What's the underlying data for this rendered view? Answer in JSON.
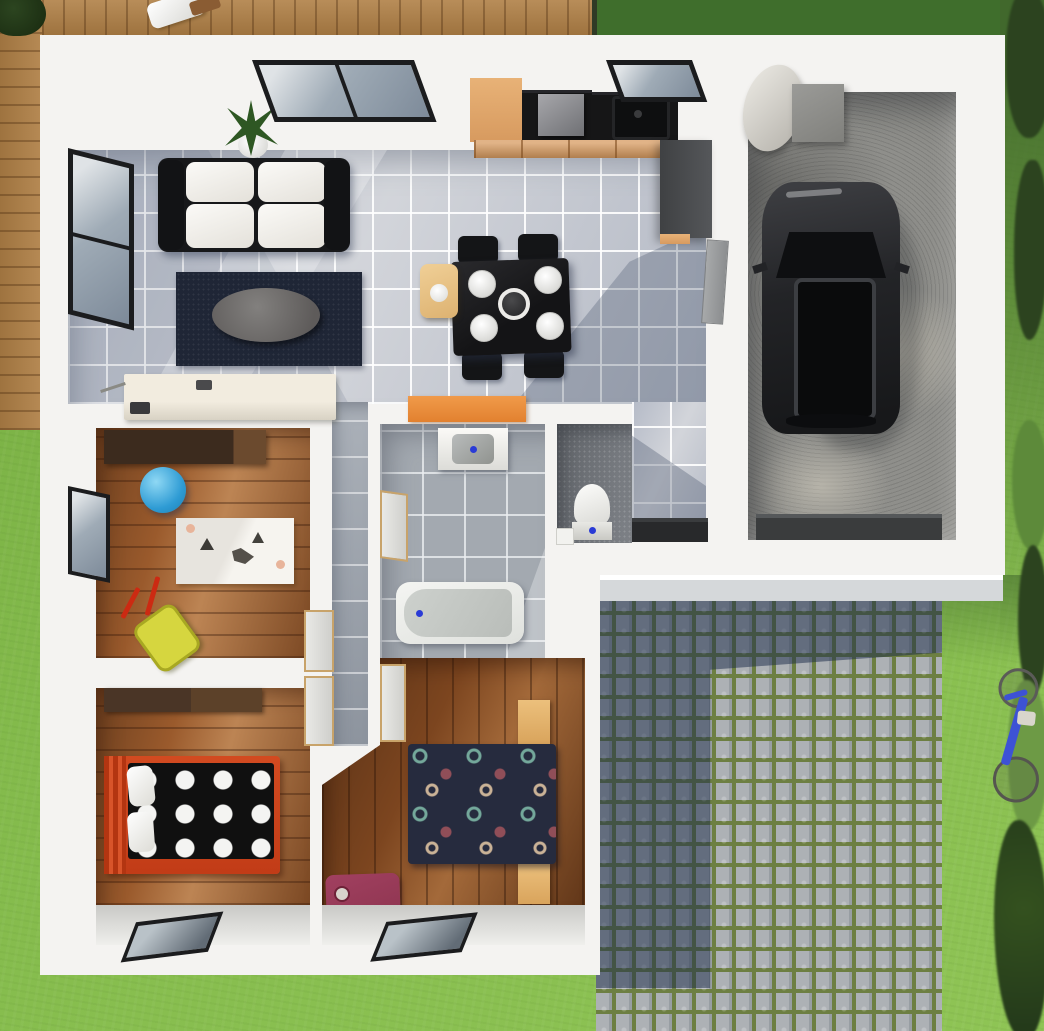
{
  "scene": {
    "kind": "3d-architectural-floor-plan-render",
    "view": "top-down",
    "size": {
      "width": 1044,
      "height": 1031
    }
  },
  "palette": {
    "grass_dark": "#41682c",
    "deck_wood": "#b08046",
    "wall_white": "#f4f3f1",
    "tile_light": "#c6c9d0",
    "wood_floor": "#9a5a2c",
    "wood_floor_dark": "#7c451f",
    "bath_tile": "#a3a9b0",
    "wc_tile": "#73777d",
    "concrete": "#8f8f8b",
    "moss": "#6d7f42",
    "cobble_shadow": "rgba(26,41,72,0.50)",
    "step": "#d5d8da",
    "counter_black": "#161617",
    "cab_wood": "#d79a5f",
    "frame_dark": "#1b1c1e",
    "wood_trim": "#c8a36a",
    "rug_navy": "#1f2636",
    "sofa_black": "#17181a",
    "orange_cabinet": "#e2812f",
    "red_bed": "#c23c17",
    "duvet_black": "#101010",
    "duvet_navy": "#262b3e",
    "blue_ball": "#2e9bd4",
    "yellow_toy": "#d6d63f",
    "maroon_bag": "#8e3550",
    "bike_blue": "#3d52d5",
    "bush_dark": "#2c431f",
    "bush_light": "#6d9a45",
    "car_body": "#232427",
    "accent_blue": "#2a3bd6"
  },
  "rooms": [
    {
      "name": "living-room",
      "furniture": [
        "sofa",
        "coffee-table",
        "navy-rug",
        "potted-plant",
        "sideboard",
        "west-window",
        "top-window"
      ]
    },
    {
      "name": "kitchen-dining",
      "furniture": [
        "tall-cabinet",
        "cooktop-with-hood",
        "black-counter",
        "sink",
        "drawer-run",
        "side-counter",
        "dining-table",
        "four-chairs",
        "four-plates",
        "center-bowl",
        "high-chair",
        "kitchen-window"
      ]
    },
    {
      "name": "hallway-entry",
      "furniture": [
        "front-door",
        "corridor"
      ]
    },
    {
      "name": "kids-room",
      "furniture": [
        "wardrobe",
        "blue-ball",
        "animal-rug",
        "toy-wheelbarrow",
        "west-window",
        "door-leaf"
      ]
    },
    {
      "name": "bathroom",
      "furniture": [
        "vanity-sink",
        "bathtub",
        "door-leaf"
      ]
    },
    {
      "name": "wc",
      "furniture": [
        "toilet",
        "small-box"
      ]
    },
    {
      "name": "bedroom-small",
      "furniture": [
        "wardrobe",
        "red-bed-black-polka-duvet",
        "pillows",
        "south-window"
      ]
    },
    {
      "name": "bedroom-master",
      "furniture": [
        "navy-patterned-double-bed",
        "two-nightstands",
        "suitcase",
        "red-tray",
        "south-window",
        "door-leaf"
      ]
    },
    {
      "name": "garage",
      "furniture": [
        "dark-suv",
        "water-heater",
        "utility-box",
        "garage-door"
      ]
    }
  ],
  "exterior": {
    "features": [
      "wood-deck",
      "deck-chair",
      "lawn",
      "cobblestone-driveway",
      "house-shadow-on-driveway",
      "entry-step",
      "hedge-row",
      "blue-bicycle",
      "corner-tree"
    ]
  }
}
